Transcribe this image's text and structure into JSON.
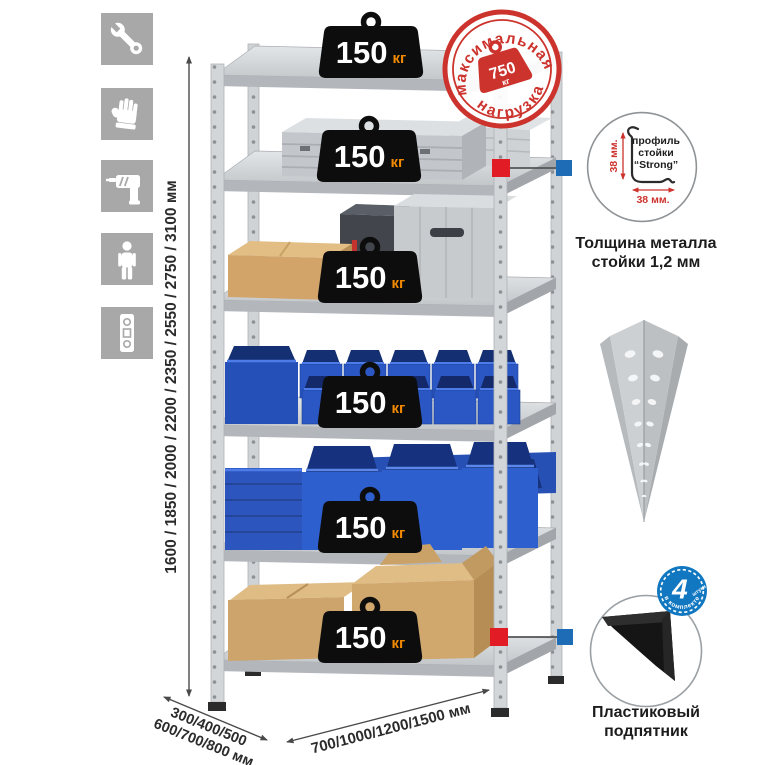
{
  "sidebar": {
    "tiles": [
      {
        "icon": "wrench-icon"
      },
      {
        "icon": "gloves-icon"
      },
      {
        "icon": "drill-icon"
      },
      {
        "icon": "person-icon"
      },
      {
        "icon": "level-icon"
      }
    ]
  },
  "rack": {
    "badges": [
      {
        "value": "150",
        "unit": "кг"
      },
      {
        "value": "150",
        "unit": "кг"
      },
      {
        "value": "150",
        "unit": "кг"
      },
      {
        "value": "150",
        "unit": "кг"
      },
      {
        "value": "150",
        "unit": "кг"
      },
      {
        "value": "150",
        "unit": "кг"
      }
    ],
    "dims": {
      "height": "1600 / 1850 / 2000 / 2200 / 2350 / 2550 / 2750 / 3100 мм",
      "depth_line1": "300/400/500",
      "depth_line2": "600/700/800 мм",
      "width": "700/1000/1200/1500 мм"
    }
  },
  "stamp": {
    "arc_top": "максимальная",
    "arc_bottom": "нагрузка",
    "weight_value": "750",
    "weight_unit": "кг"
  },
  "profile_detail": {
    "line1": "профиль",
    "line2": "стойки",
    "line3": "“Strong”",
    "dim_vertical": "38 мм.",
    "dim_horizontal": "38 мм.",
    "caption_line1": "Толщина металла",
    "caption_line2": "стойки 1,2 мм"
  },
  "foot_detail": {
    "badge_number": "4",
    "badge_word": "штуки",
    "badge_arc": "в комплекте",
    "caption_line1": "Пластиковый",
    "caption_line2": "подпятник"
  },
  "colors": {
    "stamp_red": "#cd332d",
    "connector_red": "#e11c24",
    "connector_blue": "#1e6cb5",
    "bin_blue": "#2b57c4",
    "cardboard": "#d2a96e",
    "metal_gray": "#cdd1d4",
    "badge_black": "#0d0d0d",
    "badge_unit_orange": "#f18a00",
    "tile_gray": "#a8a8a8",
    "kit_badge_blue": "#1077c0"
  }
}
